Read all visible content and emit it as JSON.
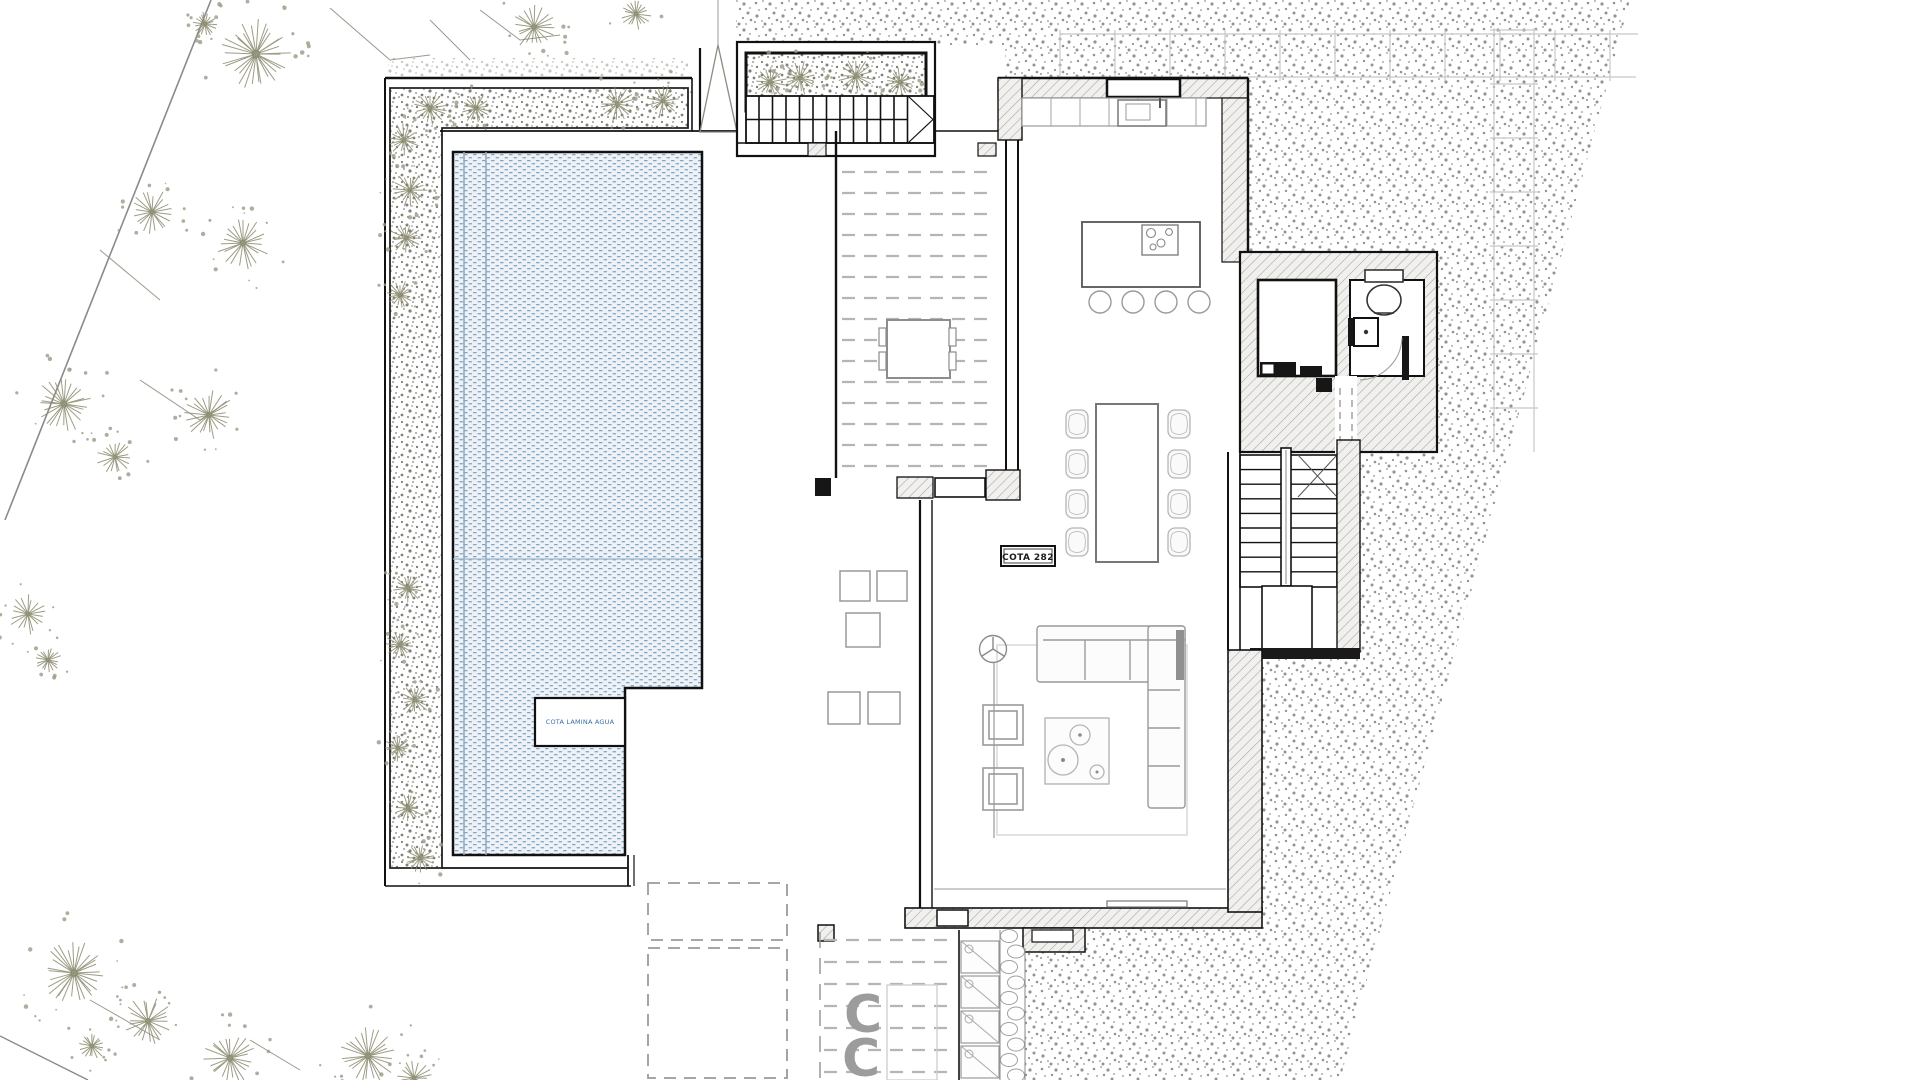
{
  "plan": {
    "labels": {
      "cota": "COTA 282",
      "pool_note": "COTA LAMINA AGUA"
    },
    "decor": {
      "c_glyphs": [
        "C",
        "C"
      ]
    },
    "colors": {
      "ink": "#1b1b1b",
      "pool_dot": "#7da3c2",
      "pool_bg": "#eef2f6",
      "pool_note_blue": "#3a6ea8",
      "terrain_dot": "#6e6e6e",
      "planter_dot": "#73736a",
      "plant": "#8b8b70",
      "wall_fill": "#f1f0ee",
      "wall_hatch": "#aaa8a2",
      "furniture_gray": "#9a9a9a",
      "deck_dash": "#b5b5b5",
      "ghost": "#c8c8c8",
      "boundary": "#8a8a8a"
    }
  }
}
